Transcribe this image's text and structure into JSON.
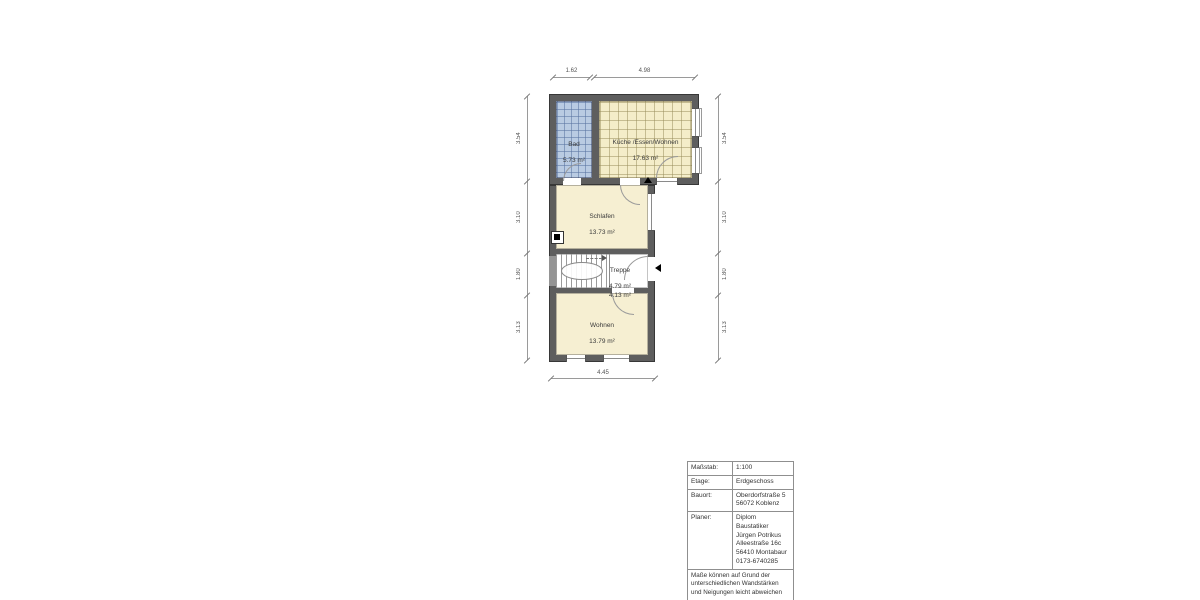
{
  "floorplan": {
    "rooms": [
      {
        "id": "bad",
        "name": "Bad",
        "area": "5.73 m²"
      },
      {
        "id": "kueche",
        "name": "Küche /Essen/Wohnen",
        "area": "17.63 m²"
      },
      {
        "id": "schlafen",
        "name": "Schlafen",
        "area": "13.73 m²"
      },
      {
        "id": "treppe",
        "name": "Treppe",
        "area": "4.79 m²\n4.13 m²"
      },
      {
        "id": "wohnen",
        "name": "Wohnen",
        "area": "13.79 m²"
      }
    ],
    "dimensions": {
      "top": [
        "1.62",
        "4.98"
      ],
      "left": [
        "3.54",
        "3.10",
        "1.80",
        "3.13"
      ],
      "right": [
        "3.54",
        "3.10",
        "1.80",
        "3.13"
      ],
      "bottom": [
        "4.45"
      ]
    },
    "colors": {
      "wall": "#5e5e5e",
      "bad_tiles": "#b9cbe2",
      "kitchen_tiles": "#f4edc9",
      "room_fill": "#f6efd2"
    }
  },
  "titleblock": {
    "rows": [
      {
        "label": "Maßstab:",
        "value": "1:100"
      },
      {
        "label": "Etage:",
        "value": "Erdgeschoss"
      },
      {
        "label": "Bauort:",
        "value": "Oberdorfstraße 5\n56072 Koblenz"
      },
      {
        "label": "Planer:",
        "value": "Diplom Baustatiker\nJürgen Potrikus\nAlleestraße 16c\n56410 Montabaur\n0173-6740285"
      }
    ],
    "note": "Maße können auf Grund der unterschiedlichen Wandstärken und Neigungen leicht abweichen"
  }
}
